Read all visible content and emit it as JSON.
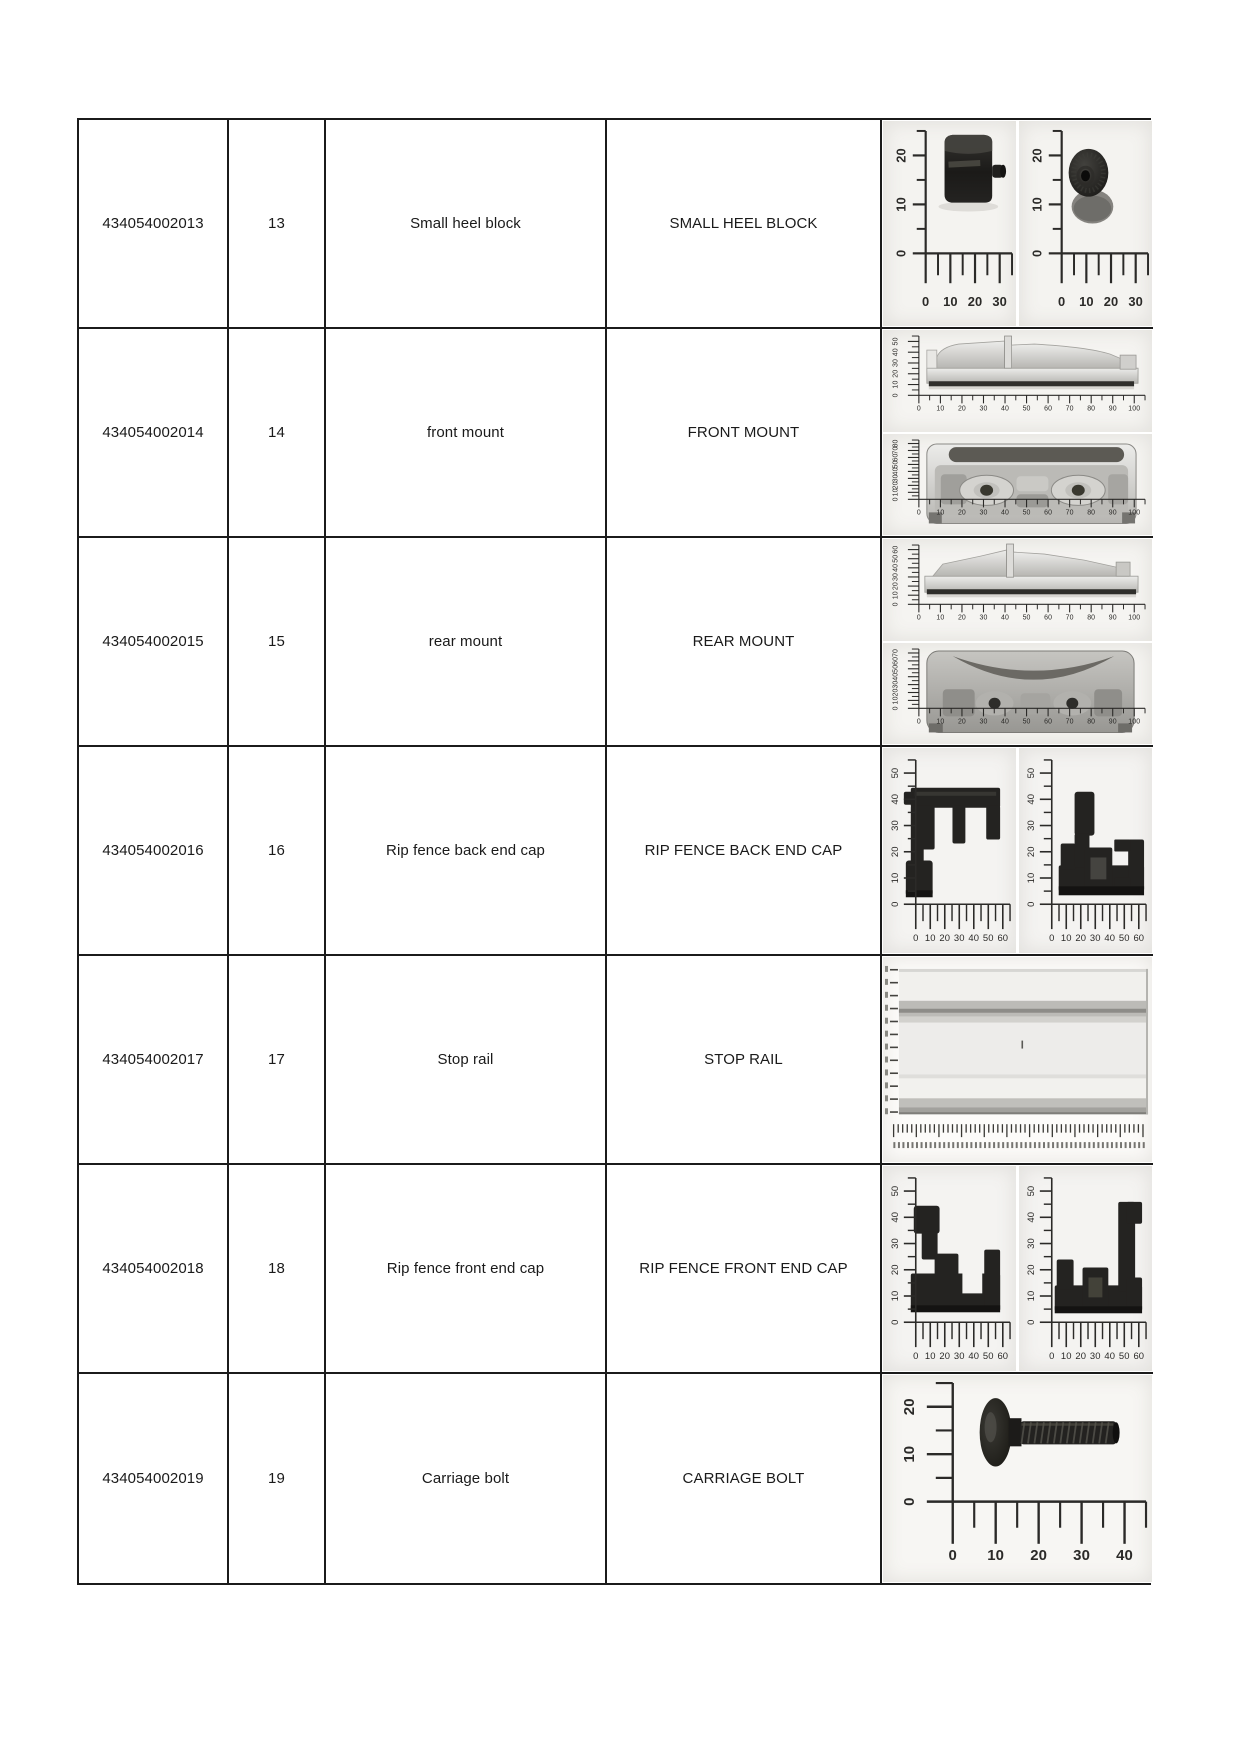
{
  "document": {
    "type": "parts-list-page",
    "background": "#ffffff",
    "table_border_color": "#1b1b1b"
  },
  "table": {
    "columns": [
      "part_number",
      "index",
      "name",
      "name_caps",
      "image"
    ],
    "rows": [
      {
        "part_number": "434054002013",
        "index": "13",
        "name": "Small heel block",
        "name_caps": "SMALL HEEL BLOCK",
        "images": [
          {
            "part": "small-heel-block-side",
            "layout": "big",
            "x_labels": [
              "0",
              "10",
              "20",
              "30"
            ],
            "y_labels": [
              "0",
              "10",
              "20"
            ]
          },
          {
            "part": "small-heel-block-top",
            "layout": "big",
            "x_labels": [
              "0",
              "10",
              "20",
              "30"
            ],
            "y_labels": [
              "0",
              "10",
              "20"
            ]
          }
        ]
      },
      {
        "part_number": "434054002014",
        "index": "14",
        "name": "front mount",
        "name_caps": "FRONT MOUNT",
        "images": [
          {
            "part": "front-mount-profile",
            "layout": "wide",
            "x_labels": [
              "0",
              "10",
              "20",
              "30",
              "40",
              "50",
              "60",
              "70",
              "80",
              "90",
              "100"
            ],
            "y_labels": [
              "0",
              "10",
              "20",
              "30",
              "40",
              "50"
            ]
          },
          {
            "part": "front-mount-underside",
            "layout": "wide",
            "x_labels": [
              "0",
              "10",
              "20",
              "30",
              "40",
              "50",
              "60",
              "70",
              "80",
              "90",
              "100"
            ],
            "y_labels": [
              "0",
              "10",
              "20",
              "30",
              "40",
              "50",
              "60",
              "70",
              "80"
            ]
          }
        ]
      },
      {
        "part_number": "434054002015",
        "index": "15",
        "name": "rear mount",
        "name_caps": "REAR MOUNT",
        "images": [
          {
            "part": "rear-mount-profile",
            "layout": "wide",
            "x_labels": [
              "0",
              "10",
              "20",
              "30",
              "40",
              "50",
              "60",
              "70",
              "80",
              "90",
              "100"
            ],
            "y_labels": [
              "0",
              "10",
              "20",
              "30",
              "40",
              "50",
              "60"
            ]
          },
          {
            "part": "rear-mount-underside",
            "layout": "wide",
            "x_labels": [
              "0",
              "10",
              "20",
              "30",
              "40",
              "50",
              "60",
              "70",
              "80",
              "90",
              "100"
            ],
            "y_labels": [
              "0",
              "10",
              "20",
              "30",
              "40",
              "50",
              "60",
              "70"
            ]
          }
        ]
      },
      {
        "part_number": "434054002016",
        "index": "16",
        "name": "Rip fence back end cap",
        "name_caps": "RIP FENCE BACK END CAP",
        "images": [
          {
            "part": "rip-fence-back-end-cap-outer",
            "layout": "mid",
            "x_labels": [
              "0",
              "10",
              "20",
              "30",
              "40",
              "50",
              "60"
            ],
            "y_labels": [
              "0",
              "10",
              "20",
              "30",
              "40",
              "50"
            ]
          },
          {
            "part": "rip-fence-back-end-cap-inner",
            "layout": "mid",
            "x_labels": [
              "0",
              "10",
              "20",
              "30",
              "40",
              "50",
              "60"
            ],
            "y_labels": [
              "0",
              "10",
              "20",
              "30",
              "40",
              "50"
            ]
          }
        ]
      },
      {
        "part_number": "434054002017",
        "index": "17",
        "name": "Stop rail",
        "name_caps": "STOP RAIL",
        "images": [
          {
            "part": "stop-rail",
            "layout": "rail",
            "x_labels": [],
            "y_labels": [],
            "note": "dense unlabeled ruler ticks"
          }
        ]
      },
      {
        "part_number": "434054002018",
        "index": "18",
        "name": "Rip fence front end cap",
        "name_caps": "RIP FENCE FRONT END CAP",
        "images": [
          {
            "part": "rip-fence-front-end-cap-outer",
            "layout": "mid",
            "x_labels": [
              "0",
              "10",
              "20",
              "30",
              "40",
              "50",
              "60"
            ],
            "y_labels": [
              "0",
              "10",
              "20",
              "30",
              "40",
              "50"
            ]
          },
          {
            "part": "rip-fence-front-end-cap-inner",
            "layout": "mid",
            "x_labels": [
              "0",
              "10",
              "20",
              "30",
              "40",
              "50",
              "60"
            ],
            "y_labels": [
              "0",
              "10",
              "20",
              "30",
              "40",
              "50"
            ]
          }
        ]
      },
      {
        "part_number": "434054002019",
        "index": "19",
        "name": "Carriage bolt",
        "name_caps": "CARRIAGE BOLT",
        "images": [
          {
            "part": "carriage-bolt",
            "layout": "bolt",
            "x_labels": [
              "0",
              "10",
              "20",
              "30",
              "40"
            ],
            "y_labels": [
              "0",
              "10",
              "20"
            ]
          }
        ]
      }
    ]
  }
}
